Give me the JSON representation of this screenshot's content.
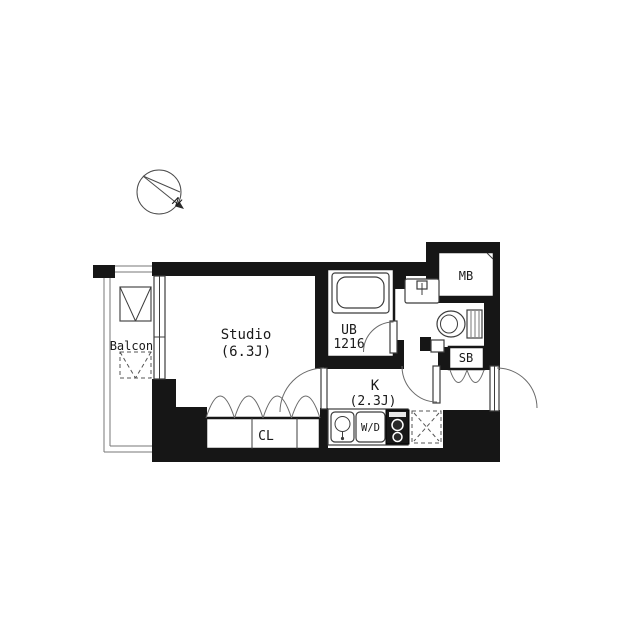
{
  "compass": {
    "north_label": "N"
  },
  "rooms": {
    "balcony": {
      "label": "Balcony"
    },
    "studio": {
      "label": "Studio",
      "size": "(6.3J)"
    },
    "kitchen": {
      "label": "K",
      "size": "(2.3J)"
    },
    "unit_bath": {
      "label": "UB",
      "size": "1216"
    },
    "closet": {
      "label": "CL"
    },
    "washer_dryer": {
      "label": "W/D"
    },
    "shoe_box": {
      "label": "SB"
    },
    "meter_box": {
      "label": "MB"
    }
  },
  "colors": {
    "wall": "#161616",
    "fixture_line": "#3c3c3c",
    "thin_line": "#777777",
    "background": "#ffffff"
  }
}
